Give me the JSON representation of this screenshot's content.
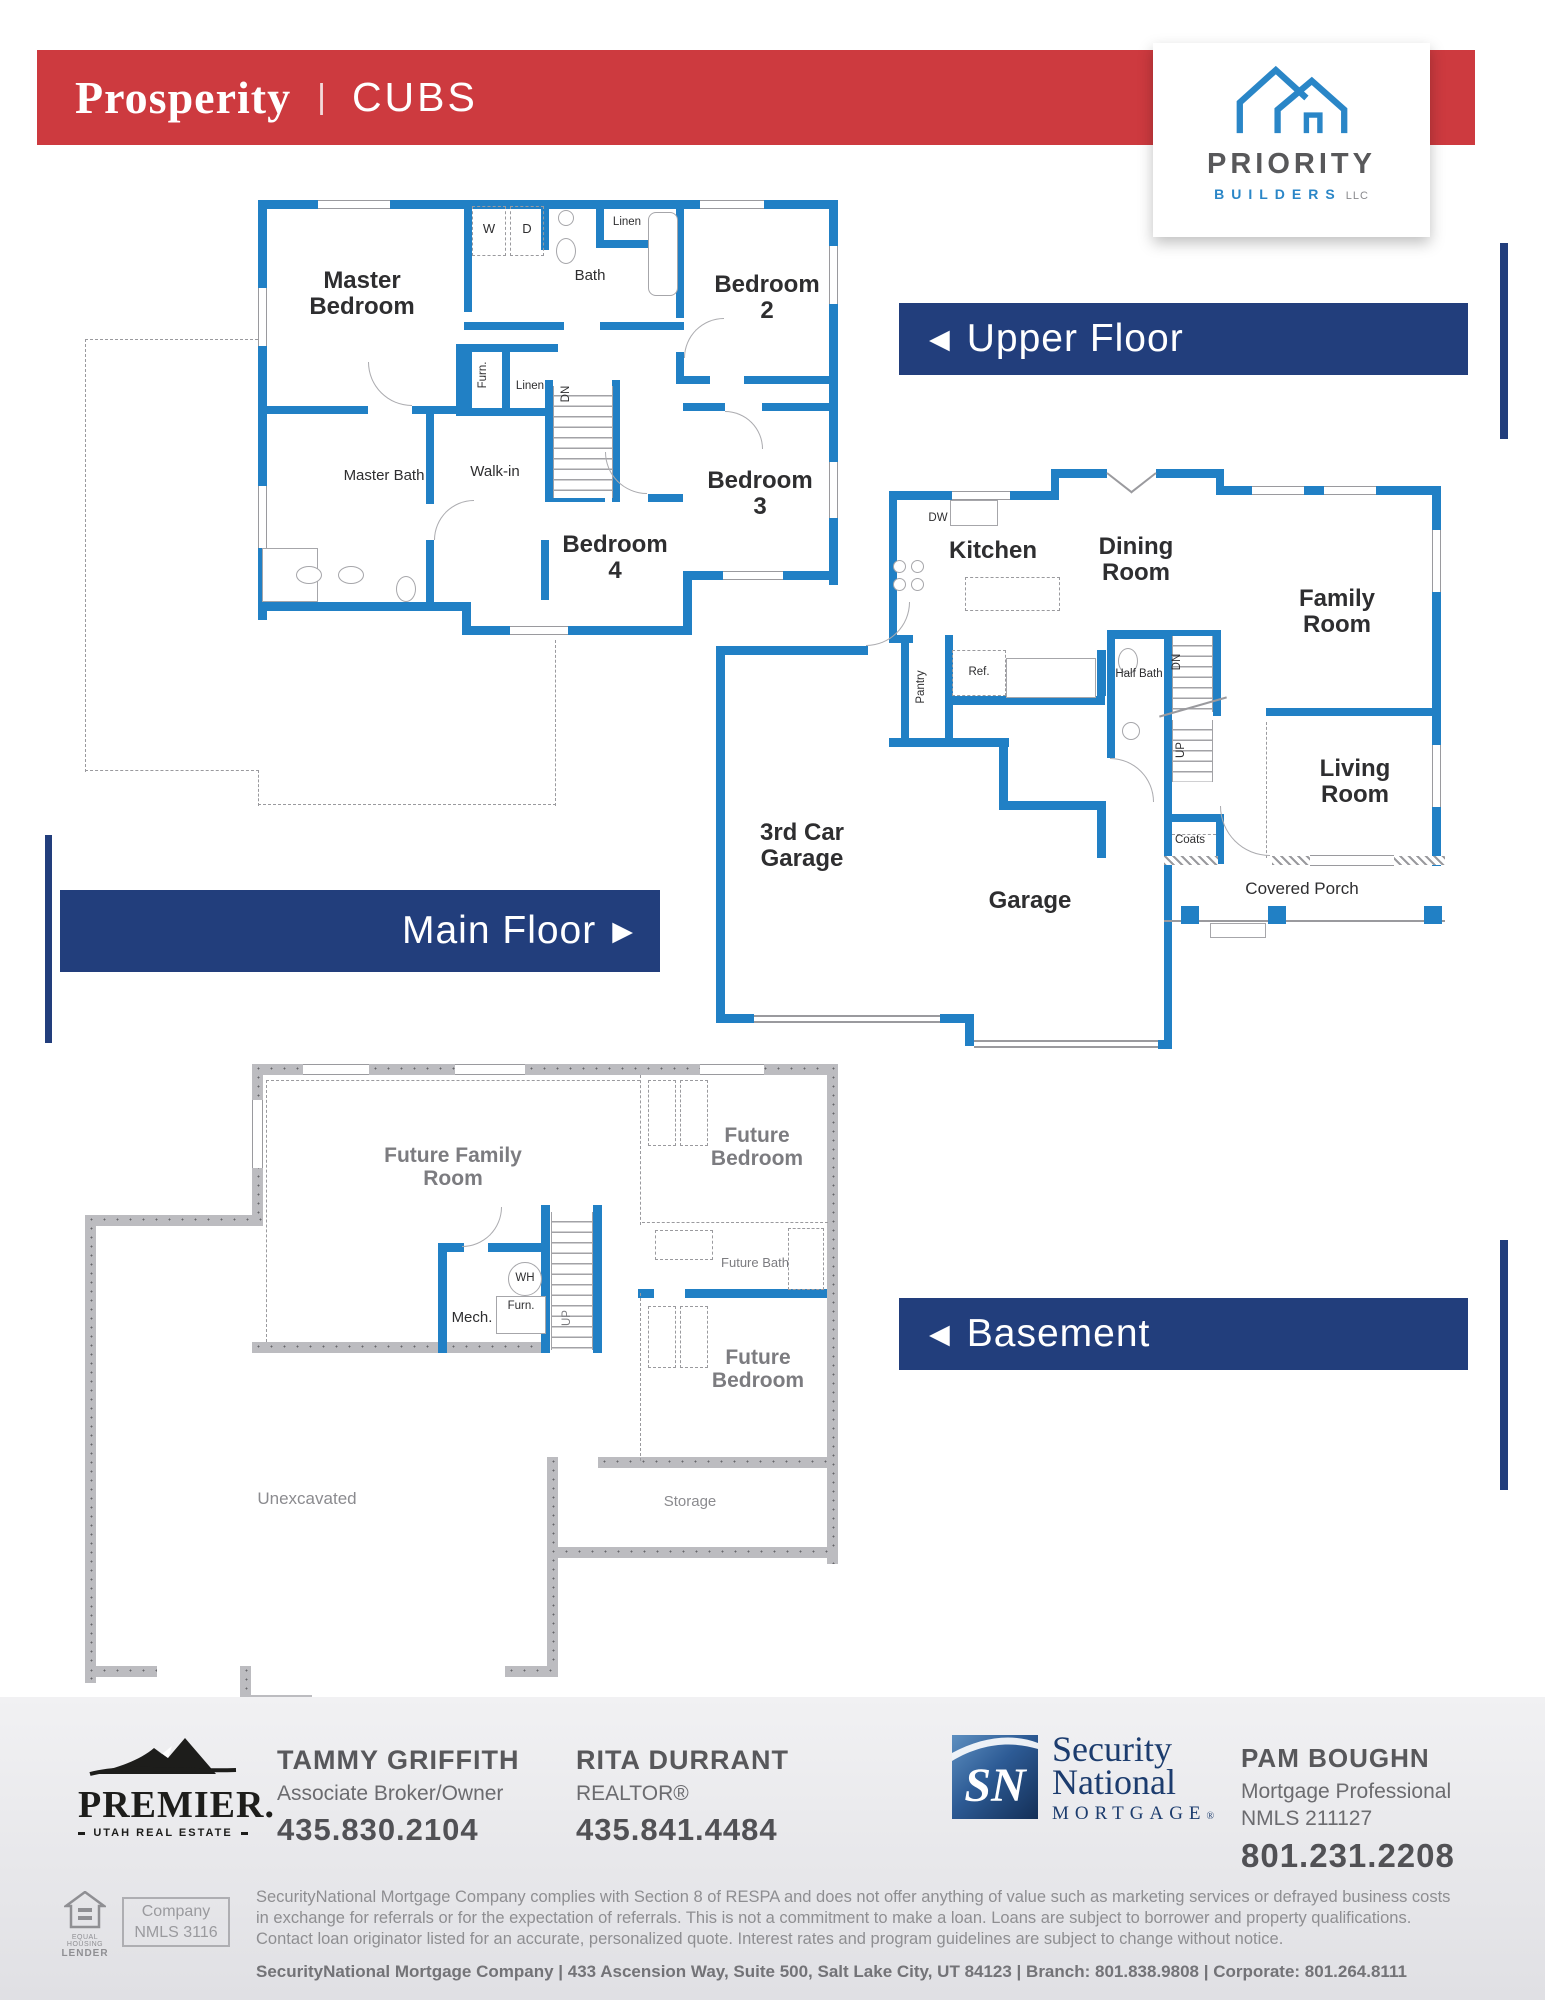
{
  "header": {
    "brand": "Prosperity",
    "sep": "|",
    "plan": "CUBS"
  },
  "logo": {
    "name": "PRIORITY",
    "sub": "BUILDERS",
    "dot": ".",
    "llc": " LLC"
  },
  "banners": {
    "upper": "Upper Floor",
    "main": "Main Floor",
    "basement": "Basement",
    "arrow_left": "◀",
    "arrow_right": "▶"
  },
  "upper": {
    "master_bedroom": "Master Bedroom",
    "bedroom2": "Bedroom 2",
    "bedroom3": "Bedroom 3",
    "bedroom4": "Bedroom 4",
    "master_bath": "Master Bath",
    "walkin": "Walk-in",
    "bath": "Bath",
    "linen": "Linen",
    "w": "W",
    "d": "D",
    "furn": "Furn.",
    "dn": "DN"
  },
  "main": {
    "kitchen": "Kitchen",
    "dining_room": "Dining Room",
    "family_room": "Family Room",
    "living_room": "Living Room",
    "third_car_garage": "3rd Car Garage",
    "garage": "Garage",
    "covered_porch": "Covered Porch",
    "half_bath": "Half Bath",
    "pantry": "Pantry",
    "ref": "Ref.",
    "dw": "DW",
    "coats": "Coats",
    "dn": "DN",
    "up": "UP"
  },
  "basement": {
    "future_family_room": "Future Family Room",
    "future_bedroom": "Future Bedroom",
    "future_bath": "Future Bath",
    "mech": "Mech.",
    "wh": "WH",
    "furn": "Furn.",
    "up": "UP",
    "unexcavated": "Unexcavated",
    "storage": "Storage"
  },
  "footer": {
    "premier": {
      "name": "PREMIER.",
      "tagline": "UTAH REAL ESTATE"
    },
    "agents": [
      {
        "name": "TAMMY GRIFFITH",
        "title": "Associate Broker/Owner",
        "phone": "435.830.2104"
      },
      {
        "name": "RITA DURRANT",
        "title": "REALTOR®",
        "phone": "435.841.4484"
      }
    ],
    "sn": {
      "initials": "SN",
      "line1": "Security",
      "line2": "National",
      "line3": "MORTGAGE",
      "reg": "®"
    },
    "loan_officer": {
      "name": "PAM BOUGHN",
      "title": "Mortgage Professional",
      "nmls": "NMLS 211127",
      "phone": "801.231.2208"
    },
    "equal_housing": {
      "line1": "EQUAL HOUSING",
      "line2": "LENDER"
    },
    "company_nmls": {
      "line1": "Company",
      "line2": "NMLS 3116"
    },
    "legal": {
      "line1": "SecurityNational Mortgage Company complies with Section 8 of RESPA and does not offer anything of value such as marketing services or defrayed business costs",
      "line2": "in exchange for referrals or for the expectation of referrals. This is not a commitment to make a loan. Loans are subject to borrower and property qualifications.",
      "line3": "Contact loan originator listed for an accurate, personalized quote. Interest rates and program guidelines are subject to change without notice."
    },
    "address": "SecurityNational Mortgage Company  |  433 Ascension Way, Suite 500, Salt Lake City, UT 84123  |  Branch: 801.838.9808  |  Corporate: 801.264.8111"
  },
  "colors": {
    "red": "#cd3a3f",
    "navy": "#223e7c",
    "wall_blue": "#2180c5",
    "logo_blue": "#2a86c7",
    "basement_wall": "#bcbcc0"
  }
}
